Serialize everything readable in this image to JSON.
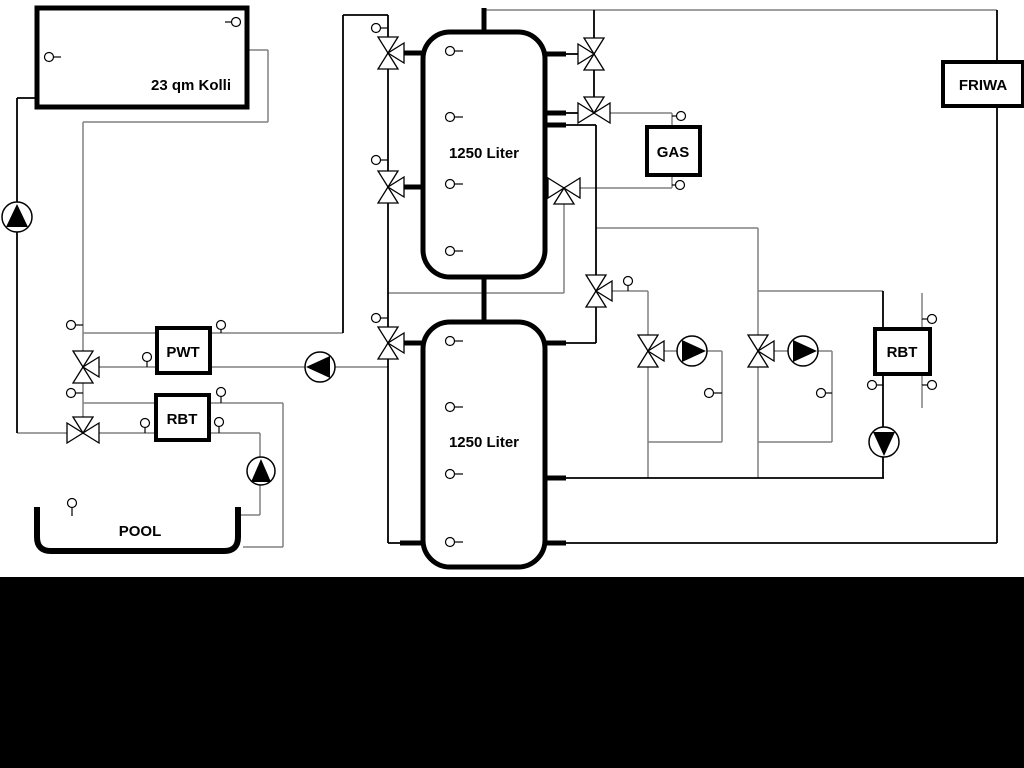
{
  "colors": {
    "background": "#ffffff",
    "pipe_gray": "#808080",
    "pipe_black": "#000000",
    "footer_bar": "#000000"
  },
  "labels": {
    "collector": "23 qm Kolli",
    "buffer_tank_top": "1250 Liter",
    "buffer_tank_bottom": "1250 Liter",
    "pwt": "PWT",
    "rbt_pool": "RBT",
    "gas": "GAS",
    "friwa": "FRIWA",
    "rbt_heating": "RBT",
    "pool": "POOL"
  }
}
